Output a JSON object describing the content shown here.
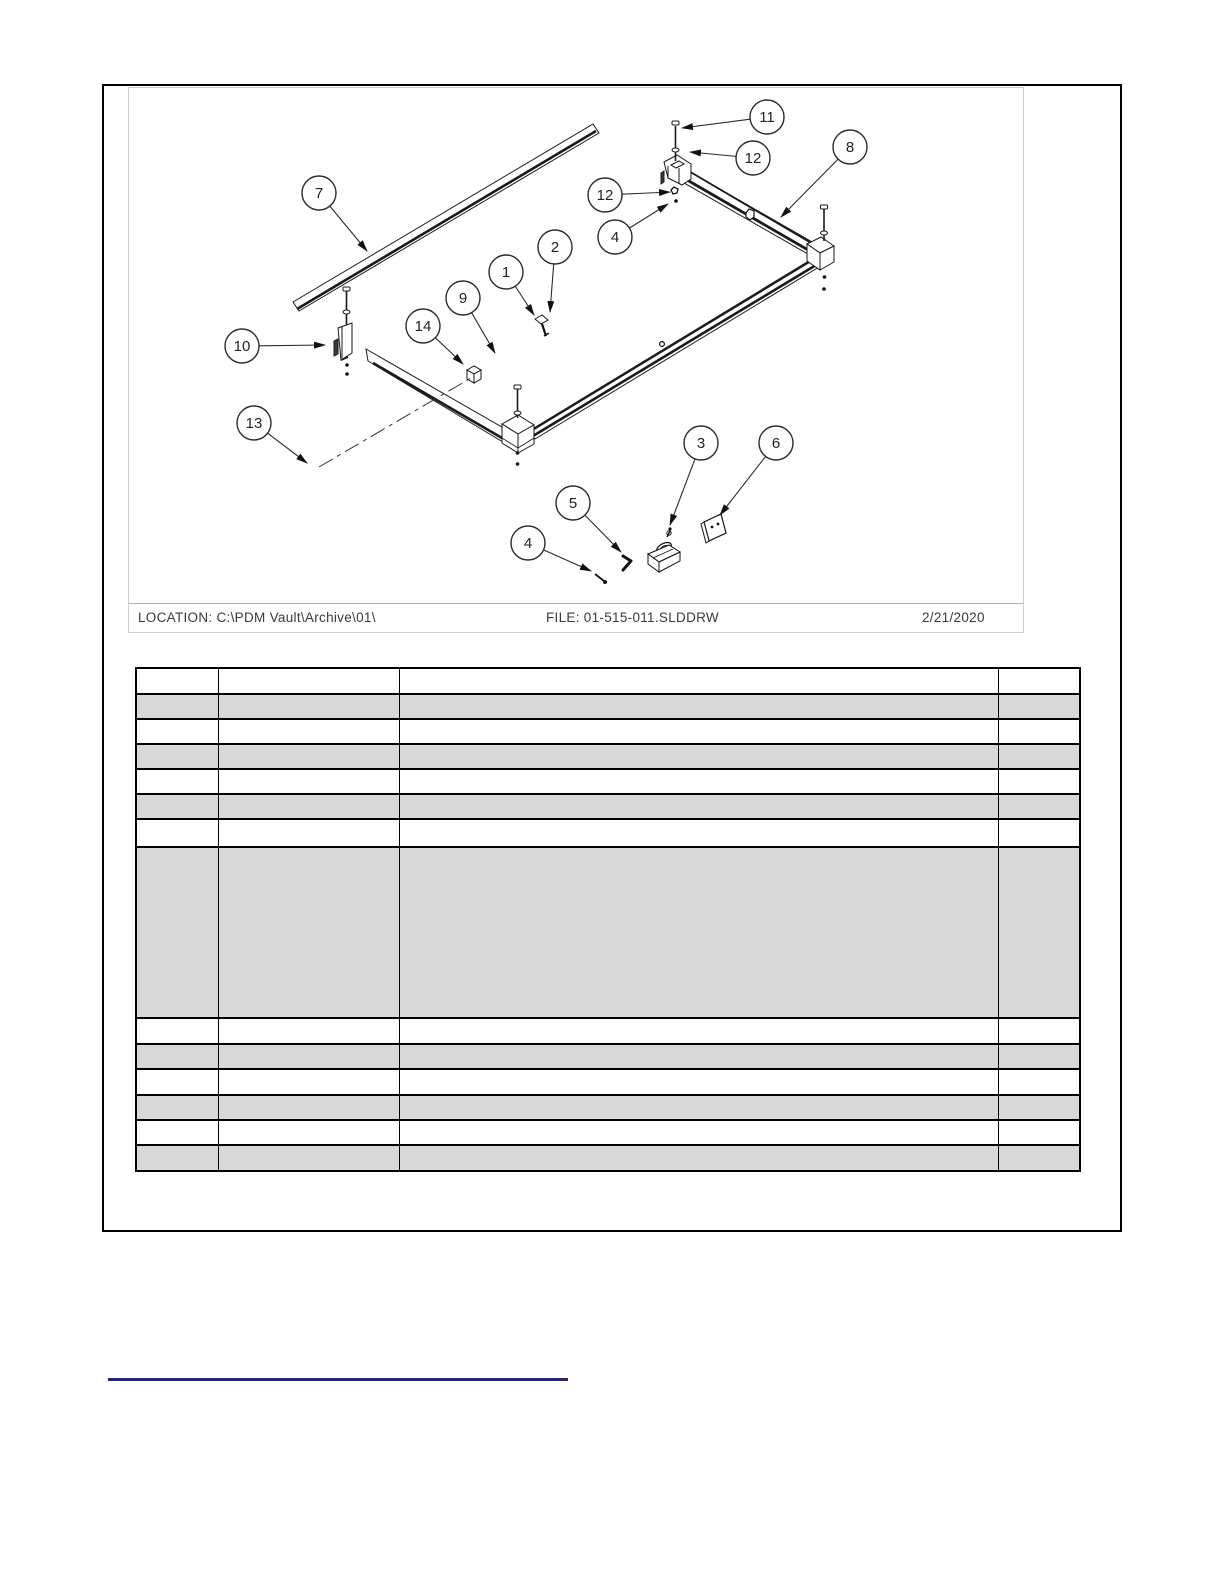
{
  "drawing": {
    "footer": {
      "location_label": "LOCATION: C:\\PDM Vault\\Archive\\01\\",
      "file_label": "FILE: 01-515-011.SLDDRW",
      "date_label": "2/21/2020"
    },
    "balloons": [
      {
        "num": "7",
        "cx": 318,
        "cy": 192,
        "tx": 366,
        "ty": 250
      },
      {
        "num": "11",
        "cx": 766,
        "cy": 116,
        "tx": 681,
        "ty": 127
      },
      {
        "num": "12",
        "cx": 752,
        "cy": 157,
        "tx": 689,
        "ty": 151
      },
      {
        "num": "8",
        "cx": 849,
        "cy": 146,
        "tx": 780,
        "ty": 216
      },
      {
        "num": "12",
        "cx": 604,
        "cy": 194,
        "tx": 669,
        "ty": 191
      },
      {
        "num": "4",
        "cx": 614,
        "cy": 236,
        "tx": 667,
        "ty": 203
      },
      {
        "num": "2",
        "cx": 554,
        "cy": 246,
        "tx": 549,
        "ty": 311
      },
      {
        "num": "1",
        "cx": 505,
        "cy": 271,
        "tx": 533,
        "ty": 314
      },
      {
        "num": "9",
        "cx": 462,
        "cy": 297,
        "tx": 494,
        "ty": 352
      },
      {
        "num": "14",
        "cx": 422,
        "cy": 325,
        "tx": 462,
        "ty": 363
      },
      {
        "num": "10",
        "cx": 241,
        "cy": 345,
        "tx": 324,
        "ty": 344
      },
      {
        "num": "13",
        "cx": 253,
        "cy": 422,
        "tx": 306,
        "ty": 462
      },
      {
        "num": "3",
        "cx": 700,
        "cy": 442,
        "tx": 669,
        "ty": 524
      },
      {
        "num": "6",
        "cx": 775,
        "cy": 442,
        "tx": 719,
        "ty": 514
      },
      {
        "num": "5",
        "cx": 572,
        "cy": 502,
        "tx": 620,
        "ty": 551
      },
      {
        "num": "4",
        "cx": 527,
        "cy": 542,
        "tx": 590,
        "ty": 570
      }
    ]
  },
  "parts_table": {
    "column_count": 4,
    "rows": [
      {
        "cells": [
          "",
          "",
          "",
          ""
        ],
        "shaded": false,
        "height": 26
      },
      {
        "cells": [
          "",
          "",
          "",
          ""
        ],
        "shaded": true,
        "height": 25
      },
      {
        "cells": [
          "",
          "",
          "",
          ""
        ],
        "shaded": false,
        "height": 25
      },
      {
        "cells": [
          "",
          "",
          "",
          ""
        ],
        "shaded": true,
        "height": 25
      },
      {
        "cells": [
          "",
          "",
          "",
          ""
        ],
        "shaded": false,
        "height": 25
      },
      {
        "cells": [
          "",
          "",
          "",
          ""
        ],
        "shaded": true,
        "height": 25
      },
      {
        "cells": [
          "",
          "",
          "",
          ""
        ],
        "shaded": false,
        "height": 28
      },
      {
        "cells": [
          "",
          "",
          "",
          ""
        ],
        "shaded": true,
        "height": 171
      },
      {
        "cells": [
          "",
          "",
          "",
          ""
        ],
        "shaded": false,
        "height": 26
      },
      {
        "cells": [
          "",
          "",
          "",
          ""
        ],
        "shaded": true,
        "height": 25
      },
      {
        "cells": [
          "",
          "",
          "",
          ""
        ],
        "shaded": false,
        "height": 26
      },
      {
        "cells": [
          "",
          "",
          "",
          ""
        ],
        "shaded": true,
        "height": 25
      },
      {
        "cells": [
          "",
          "",
          "",
          ""
        ],
        "shaded": false,
        "height": 25
      },
      {
        "cells": [
          "",
          "",
          "",
          ""
        ],
        "shaded": true,
        "height": 26
      }
    ]
  },
  "colors": {
    "bottom_rule": "#23237e",
    "line": "#1a1a1a",
    "table_shade": "#d8d8d8"
  }
}
